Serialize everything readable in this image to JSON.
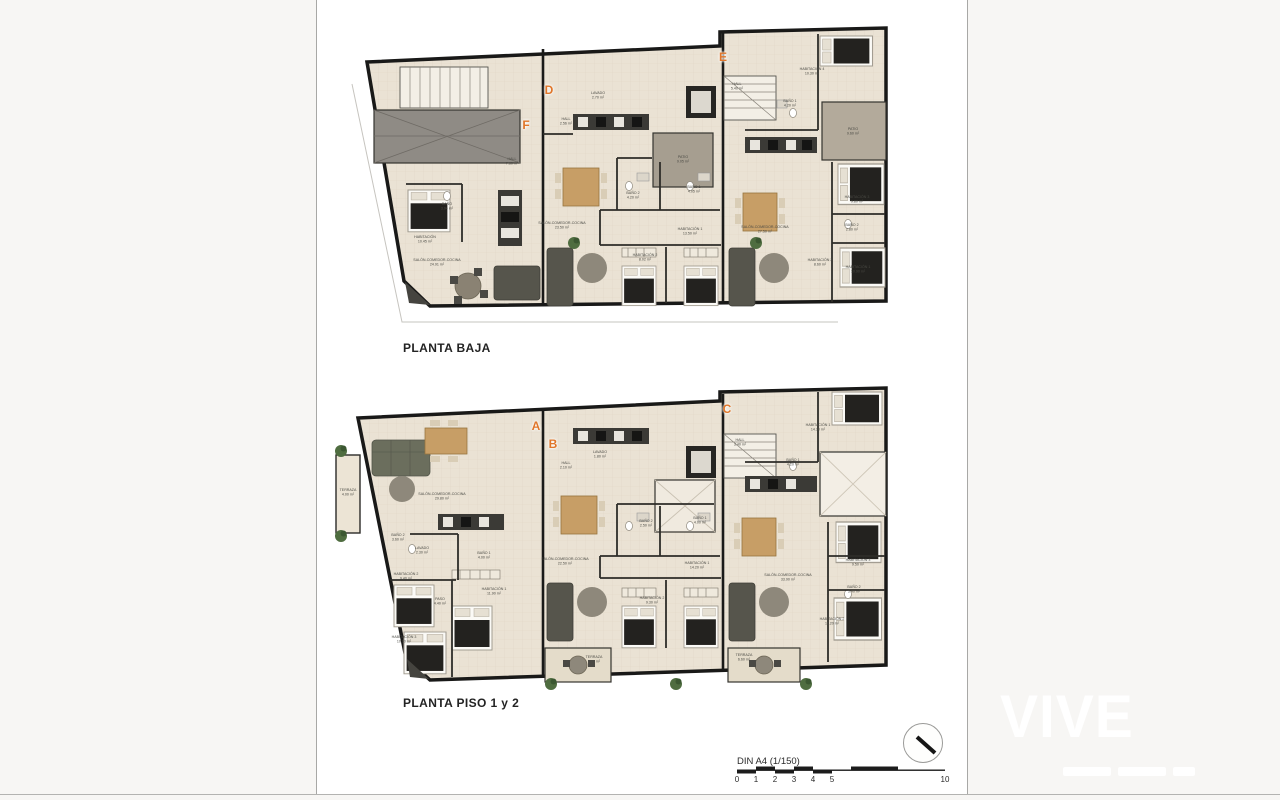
{
  "document": {
    "background_color": "#f7f6f4",
    "sheet_color": "#ffffff",
    "wall_color": "#191918",
    "floor_color": "#eae2d4",
    "accent_color": "#e0762a"
  },
  "plans": [
    {
      "title": "PLANTA BAJA",
      "units": [
        {
          "label": "F",
          "x": 526,
          "y": 125
        },
        {
          "label": "D",
          "x": 549,
          "y": 90
        },
        {
          "label": "E",
          "x": 723,
          "y": 57
        }
      ],
      "rooms": [
        {
          "name": "HALL",
          "area": "7.60 m²",
          "x": 512,
          "y": 162
        },
        {
          "name": "BAÑO",
          "area": "3.94 m²",
          "x": 447,
          "y": 207
        },
        {
          "name": "HABITACIÓN",
          "area": "10.45 m²",
          "x": 425,
          "y": 240
        },
        {
          "name": "SALÓN-COMEDOR-COCINA",
          "area": "24.91 m²",
          "x": 437,
          "y": 263
        },
        {
          "name": "HALL",
          "area": "2.56 m²",
          "x": 566,
          "y": 122
        },
        {
          "name": "LAVADO",
          "area": "2.70 m²",
          "x": 598,
          "y": 96
        },
        {
          "name": "PATIO",
          "area": "9.05 m²",
          "x": 683,
          "y": 160
        },
        {
          "name": "SALÓN-COMEDOR-COCINA",
          "area": "23.50 m²",
          "x": 562,
          "y": 226
        },
        {
          "name": "BAÑO 2",
          "area": "4.20 m²",
          "x": 633,
          "y": 196
        },
        {
          "name": "BAÑO 1",
          "area": "4.05 m²",
          "x": 694,
          "y": 190
        },
        {
          "name": "HABITACIÓN 1",
          "area": "13.50 m²",
          "x": 690,
          "y": 232
        },
        {
          "name": "HABITACIÓN 2",
          "area": "8.02 m²",
          "x": 645,
          "y": 258
        },
        {
          "name": "HALL",
          "area": "5.40 m²",
          "x": 737,
          "y": 87
        },
        {
          "name": "HABITACIÓN 4",
          "area": "10.30 m²",
          "x": 812,
          "y": 72
        },
        {
          "name": "BAÑO 1",
          "area": "4.20 m²",
          "x": 790,
          "y": 104
        },
        {
          "name": "PATIO",
          "area": "9.60 m²",
          "x": 853,
          "y": 132
        },
        {
          "name": "SALÓN-COMEDOR-COCINA",
          "area": "27.50 m²",
          "x": 765,
          "y": 230
        },
        {
          "name": "HABITACIÓN 3",
          "area": "9.80 m²",
          "x": 857,
          "y": 200
        },
        {
          "name": "BAÑO 2",
          "area": "2.80 m²",
          "x": 852,
          "y": 228
        },
        {
          "name": "HABITACIÓN 2",
          "area": "8.60 m²",
          "x": 820,
          "y": 263
        },
        {
          "name": "HABITACIÓN 1",
          "area": "10.90 m²",
          "x": 858,
          "y": 270
        }
      ]
    },
    {
      "title": "PLANTA PISO 1 y 2",
      "units": [
        {
          "label": "A",
          "x": 536,
          "y": 426
        },
        {
          "label": "B",
          "x": 553,
          "y": 444
        },
        {
          "label": "C",
          "x": 727,
          "y": 409
        }
      ],
      "rooms": [
        {
          "name": "TERRAZA",
          "area": "4.00 m²",
          "x": 348,
          "y": 493
        },
        {
          "name": "SALÓN-COMEDOR-COCINA",
          "area": "29.80 m²",
          "x": 442,
          "y": 497
        },
        {
          "name": "BAÑO 2",
          "area": "3.60 m²",
          "x": 398,
          "y": 538
        },
        {
          "name": "LAVADO",
          "area": "2.30 m²",
          "x": 422,
          "y": 551
        },
        {
          "name": "BAÑO 1",
          "area": "4.00 m²",
          "x": 484,
          "y": 556
        },
        {
          "name": "HABITACIÓN 2",
          "area": "9.40 m²",
          "x": 406,
          "y": 577
        },
        {
          "name": "PASO",
          "area": "4.40 m²",
          "x": 440,
          "y": 602
        },
        {
          "name": "HABITACIÓN 1",
          "area": "11.90 m²",
          "x": 494,
          "y": 592
        },
        {
          "name": "HABITACIÓN 3",
          "area": "10.90 m²",
          "x": 404,
          "y": 640
        },
        {
          "name": "HALL",
          "area": "2.10 m²",
          "x": 566,
          "y": 466
        },
        {
          "name": "LAVADO",
          "area": "1.80 m²",
          "x": 600,
          "y": 455
        },
        {
          "name": "SALÓN-COMEDOR-COCINA",
          "area": "22.50 m²",
          "x": 565,
          "y": 562
        },
        {
          "name": "BAÑO 2",
          "area": "2.50 m²",
          "x": 646,
          "y": 524
        },
        {
          "name": "BAÑO 1",
          "area": "4.00 m²",
          "x": 700,
          "y": 521
        },
        {
          "name": "HABITACIÓN 1",
          "area": "14.20 m²",
          "x": 697,
          "y": 566
        },
        {
          "name": "HABITACIÓN 2",
          "area": "9.30 m²",
          "x": 652,
          "y": 601
        },
        {
          "name": "TERRAZA",
          "area": "6.50 m²",
          "x": 594,
          "y": 660
        },
        {
          "name": "HALL",
          "area": "3.40 m²",
          "x": 740,
          "y": 443
        },
        {
          "name": "HABITACIÓN 1",
          "area": "14.30 m²",
          "x": 818,
          "y": 428
        },
        {
          "name": "BAÑO 1",
          "area": "4.20 m²",
          "x": 793,
          "y": 463
        },
        {
          "name": "SALÓN-COMEDOR-COCINA",
          "area": "33.90 m²",
          "x": 788,
          "y": 578
        },
        {
          "name": "HABITACIÓN 3",
          "area": "9.50 m²",
          "x": 858,
          "y": 563
        },
        {
          "name": "BAÑO 2",
          "area": "3.40 m²",
          "x": 854,
          "y": 590
        },
        {
          "name": "HABITACIÓN 2",
          "area": "11.20 m²",
          "x": 832,
          "y": 622
        },
        {
          "name": "TERRAZA",
          "area": "6.60 m²",
          "x": 744,
          "y": 658
        }
      ]
    }
  ],
  "scale_bar": {
    "label": "DIN A4 (1/150)",
    "ticks": [
      {
        "label": "0",
        "x": 737,
        "y": 775
      },
      {
        "label": "1",
        "x": 756,
        "y": 775
      },
      {
        "label": "2",
        "x": 775,
        "y": 775
      },
      {
        "label": "3",
        "x": 794,
        "y": 775
      },
      {
        "label": "4",
        "x": 813,
        "y": 775
      },
      {
        "label": "5",
        "x": 832,
        "y": 775
      },
      {
        "label": "10",
        "x": 945,
        "y": 775
      }
    ]
  },
  "watermark": {
    "text": "VIVE"
  }
}
